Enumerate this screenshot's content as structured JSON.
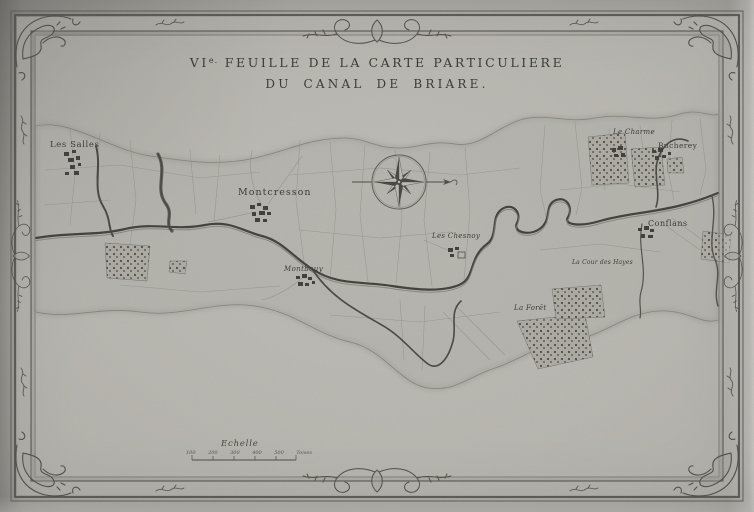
{
  "title": {
    "volume_numeral": "VI",
    "volume_suffix": "e.",
    "line1_rest": "FEUILLE DE LA CARTE PARTICULIERE",
    "line2": "DU CANAL DE BRIARE."
  },
  "map": {
    "labels": [
      {
        "id": "les-salles",
        "text": "Les Salles"
      },
      {
        "id": "montcresson",
        "text": "Montcresson"
      },
      {
        "id": "montbouy",
        "text": "Montbouy"
      },
      {
        "id": "les-chesnoy",
        "text": "Les Chesnoy"
      },
      {
        "id": "le-charme",
        "text": "Le Charme"
      },
      {
        "id": "bucherey",
        "text": "Bucherey"
      },
      {
        "id": "conflans",
        "text": "Conflans"
      },
      {
        "id": "cour-des-hayes",
        "text": "La Cour des Hayes"
      },
      {
        "id": "la-foret",
        "text": "La Forêt"
      }
    ]
  },
  "scale": {
    "label": "Echelle",
    "ticks": [
      "100",
      "200",
      "300",
      "400",
      "500"
    ],
    "unit": "Toises"
  },
  "icons": {
    "compass": "compass-rose"
  },
  "colors": {
    "paper": "#b6b4ae",
    "ink": "#413f3b",
    "highlight": "#dbd9d5"
  }
}
